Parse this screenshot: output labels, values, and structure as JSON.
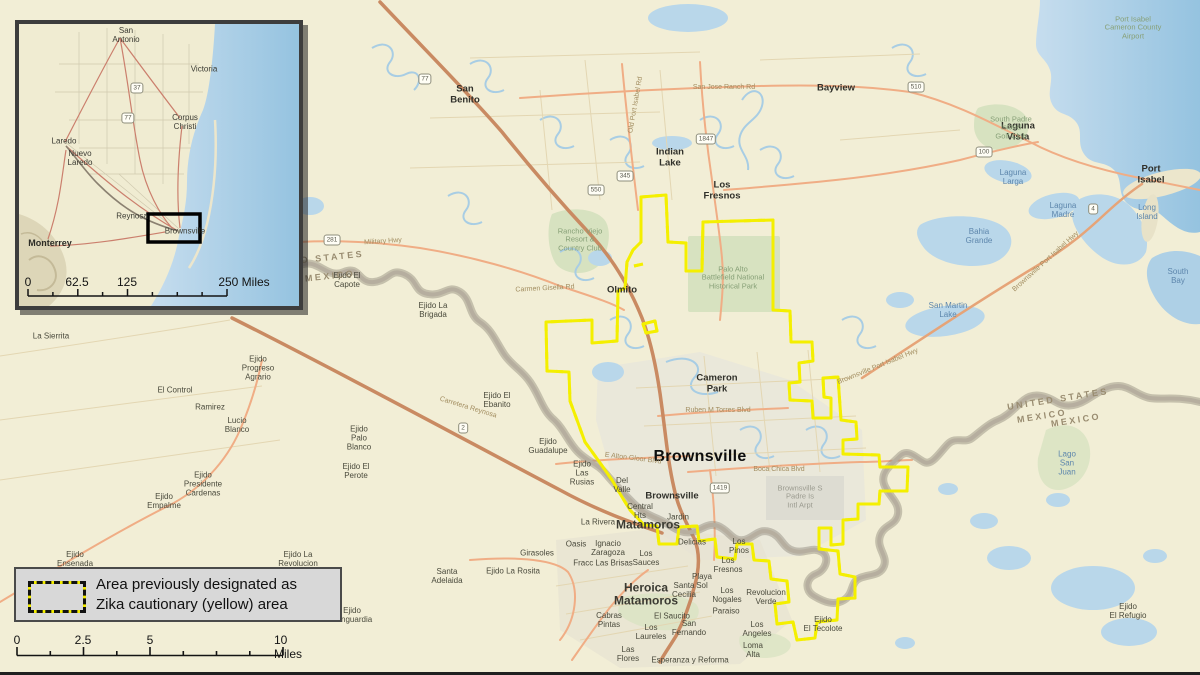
{
  "colors": {
    "land": "#f2eed6",
    "water": "#b9d7ea",
    "water_deep": "#9cc6e0",
    "park": "#d7e2c0",
    "urban": "#e9e6db",
    "airport_gray": "#dddcd2",
    "road_major": "#c98a62",
    "road_secondary": "#f0ad85",
    "river_gray": "#b3ab9c",
    "zika_yellow": "#f4ef00",
    "zika_black": "#141414",
    "legend_bg": "#d8d8d8"
  },
  "legend": {
    "line1": "Area previously designated as",
    "line2": "Zika cautionary (yellow) area"
  },
  "scalebar": {
    "labels": [
      {
        "t": "0",
        "x": 17
      },
      {
        "t": "2.5",
        "x": 83
      },
      {
        "t": "5",
        "x": 150
      },
      {
        "t": "10 Miles",
        "x": 296
      }
    ]
  },
  "inset": {
    "labels": [
      {
        "t": "San\nAntonio",
        "x": 107,
        "y": 12,
        "c": "ins-town"
      },
      {
        "t": "Victoria",
        "x": 185,
        "y": 46,
        "c": "ins-town"
      },
      {
        "t": "Corpus\nChristi",
        "x": 166,
        "y": 99,
        "c": "ins-town"
      },
      {
        "t": "Laredo",
        "x": 45,
        "y": 118,
        "c": "ins-town"
      },
      {
        "t": "Nuevo\nLaredo",
        "x": 61,
        "y": 135,
        "c": "ins-town"
      },
      {
        "t": "Reynosa",
        "x": 113,
        "y": 193,
        "c": "ins-town"
      },
      {
        "t": "Brownsville",
        "x": 166,
        "y": 208,
        "c": "ins-town"
      },
      {
        "t": "Monterrey",
        "x": 31,
        "y": 219,
        "c": "ins-city"
      }
    ],
    "shields": [
      {
        "n": "37",
        "x": 118,
        "y": 64
      },
      {
        "n": "77",
        "x": 109,
        "y": 94
      }
    ],
    "scale_labels": [
      {
        "t": "0",
        "x": 9
      },
      {
        "t": "62.5",
        "x": 58
      },
      {
        "t": "125",
        "x": 108
      },
      {
        "t": "250 Miles",
        "x": 225
      }
    ]
  },
  "map": {
    "labels": [
      {
        "t": "Brownsville",
        "x": 700,
        "y": 457,
        "c": "city"
      },
      {
        "t": "San\nBenito",
        "x": 465,
        "y": 95,
        "c": "town"
      },
      {
        "t": "Bayview",
        "x": 836,
        "y": 89,
        "c": "town"
      },
      {
        "t": "Indian\nLake",
        "x": 670,
        "y": 158,
        "c": "town"
      },
      {
        "t": "Los\nFresnos",
        "x": 722,
        "y": 191,
        "c": "town"
      },
      {
        "t": "Laguna\nVista",
        "x": 1018,
        "y": 132,
        "c": "town"
      },
      {
        "t": "Port\nIsabel",
        "x": 1151,
        "y": 175,
        "c": "town"
      },
      {
        "t": "Olmito",
        "x": 622,
        "y": 291,
        "c": "town"
      },
      {
        "t": "Cameron\nPark",
        "x": 717,
        "y": 384,
        "c": "town"
      },
      {
        "t": "Brownsville",
        "x": 672,
        "y": 497,
        "c": "town"
      },
      {
        "t": "Matamoros",
        "x": 648,
        "y": 525,
        "c": "town2"
      },
      {
        "t": "Heroica\nMatamoros",
        "x": 646,
        "y": 595,
        "c": "town2"
      },
      {
        "t": "Ejido El\nCapote",
        "x": 347,
        "y": 281,
        "c": "place"
      },
      {
        "t": "Ejido La\nBrigada",
        "x": 433,
        "y": 311,
        "c": "place"
      },
      {
        "t": "Ejido El\nEbanito",
        "x": 497,
        "y": 401,
        "c": "place"
      },
      {
        "t": "Ejido\nPalo\nBlanco",
        "x": 359,
        "y": 439,
        "c": "place"
      },
      {
        "t": "Ejido El\nPerote",
        "x": 356,
        "y": 472,
        "c": "place"
      },
      {
        "t": "Ejido\nProgreso\nAgrario",
        "x": 258,
        "y": 369,
        "c": "place"
      },
      {
        "t": "El Control",
        "x": 175,
        "y": 391,
        "c": "place"
      },
      {
        "t": "Ramirez",
        "x": 210,
        "y": 408,
        "c": "place"
      },
      {
        "t": "Lucio\nBlanco",
        "x": 237,
        "y": 426,
        "c": "place"
      },
      {
        "t": "Ejido\nPresidente\nCardenas",
        "x": 203,
        "y": 485,
        "c": "place"
      },
      {
        "t": "Ejido\nEmpalme",
        "x": 164,
        "y": 502,
        "c": "place"
      },
      {
        "t": "La Sierrita",
        "x": 51,
        "y": 337,
        "c": "place"
      },
      {
        "t": "Ejido\nGuadalupe",
        "x": 548,
        "y": 447,
        "c": "place"
      },
      {
        "t": "Ejido\nLas\nRusias",
        "x": 582,
        "y": 474,
        "c": "place"
      },
      {
        "t": "Del\nValle",
        "x": 622,
        "y": 486,
        "c": "place"
      },
      {
        "t": "Central\nHts",
        "x": 640,
        "y": 512,
        "c": "place"
      },
      {
        "t": "Jardin",
        "x": 678,
        "y": 518,
        "c": "place"
      },
      {
        "t": "La Rivera",
        "x": 598,
        "y": 523,
        "c": "place"
      },
      {
        "t": "Ejido\nEnsenada",
        "x": 75,
        "y": 560,
        "c": "place"
      },
      {
        "t": "Ejido La\nRevolucion",
        "x": 298,
        "y": 560,
        "c": "place"
      },
      {
        "t": "Ejido\nVanguardia",
        "x": 352,
        "y": 616,
        "c": "place"
      },
      {
        "t": "Ejido La Rosita",
        "x": 513,
        "y": 572,
        "c": "place"
      },
      {
        "t": "Girasoles",
        "x": 537,
        "y": 554,
        "c": "place"
      },
      {
        "t": "Oasis",
        "x": 576,
        "y": 545,
        "c": "place"
      },
      {
        "t": "Ignacio\nZaragoza",
        "x": 608,
        "y": 549,
        "c": "place"
      },
      {
        "t": "Fracc Las Brisas",
        "x": 603,
        "y": 564,
        "c": "place"
      },
      {
        "t": "Los\nSauces",
        "x": 646,
        "y": 559,
        "c": "place"
      },
      {
        "t": "Delicias",
        "x": 692,
        "y": 543,
        "c": "place"
      },
      {
        "t": "Los\nPinos",
        "x": 739,
        "y": 547,
        "c": "place"
      },
      {
        "t": "Los\nFresnos",
        "x": 728,
        "y": 566,
        "c": "place"
      },
      {
        "t": "Playa\nSol",
        "x": 702,
        "y": 582,
        "c": "place"
      },
      {
        "t": "Santa\nCecilia",
        "x": 684,
        "y": 591,
        "c": "place"
      },
      {
        "t": "Los\nNogales",
        "x": 727,
        "y": 596,
        "c": "place"
      },
      {
        "t": "Paraiso",
        "x": 726,
        "y": 612,
        "c": "place"
      },
      {
        "t": "Revolucion\nVerde",
        "x": 766,
        "y": 598,
        "c": "place"
      },
      {
        "t": "Ejido\nEl Tecolote",
        "x": 823,
        "y": 625,
        "c": "place"
      },
      {
        "t": "Ejido\nEl Refugio",
        "x": 1128,
        "y": 612,
        "c": "place"
      },
      {
        "t": "Cabras\nPintas",
        "x": 609,
        "y": 621,
        "c": "place"
      },
      {
        "t": "El Saucito",
        "x": 672,
        "y": 617,
        "c": "place"
      },
      {
        "t": "San\nFernando",
        "x": 689,
        "y": 629,
        "c": "place"
      },
      {
        "t": "Los\nLaureles",
        "x": 651,
        "y": 633,
        "c": "place"
      },
      {
        "t": "Los\nAngeles",
        "x": 757,
        "y": 630,
        "c": "place"
      },
      {
        "t": "Loma\nAlta",
        "x": 753,
        "y": 651,
        "c": "place"
      },
      {
        "t": "Las\nFlores",
        "x": 628,
        "y": 655,
        "c": "place"
      },
      {
        "t": "Esperanza y Reforma",
        "x": 690,
        "y": 661,
        "c": "place"
      },
      {
        "t": "Santa\nAdelaida",
        "x": 447,
        "y": 577,
        "c": "place"
      },
      {
        "t": "Bahia\nGrande",
        "x": 979,
        "y": 237,
        "c": "water"
      },
      {
        "t": "Laguna\nLarga",
        "x": 1013,
        "y": 178,
        "c": "water"
      },
      {
        "t": "Laguna\nMadre",
        "x": 1063,
        "y": 211,
        "c": "water"
      },
      {
        "t": "Long\nIsland",
        "x": 1147,
        "y": 213,
        "c": "water"
      },
      {
        "t": "South\nBay",
        "x": 1178,
        "y": 277,
        "c": "water"
      },
      {
        "t": "San Martin\nLake",
        "x": 948,
        "y": 311,
        "c": "water"
      },
      {
        "t": "Lago\nSan\nJuan",
        "x": 1067,
        "y": 464,
        "c": "water"
      },
      {
        "t": "Palo Alto\nBattlefield National\nHistorical Park",
        "x": 733,
        "y": 278,
        "c": "park"
      },
      {
        "t": "Rancho Viejo\nResort &\nCountry Club",
        "x": 580,
        "y": 240,
        "c": "park"
      },
      {
        "t": "Port Isabel\nCameron County\nAirport",
        "x": 1133,
        "y": 28,
        "c": "park"
      },
      {
        "t": "South Padre\nIsland\nGolf Club",
        "x": 1011,
        "y": 128,
        "c": "park"
      },
      {
        "t": "Brownsville S\nPadre Is\nIntl Arpt",
        "x": 800,
        "y": 497,
        "c": "airport"
      },
      {
        "t": "Military Hwy",
        "x": 383,
        "y": 242,
        "c": "road",
        "r": -4
      },
      {
        "t": "San Jose Ranch Rd",
        "x": 724,
        "y": 88,
        "c": "road"
      },
      {
        "t": "Carmen Gisella Rd",
        "x": 545,
        "y": 289,
        "c": "road",
        "r": -3
      },
      {
        "t": "Ruben M Torres Blvd",
        "x": 718,
        "y": 411,
        "c": "road"
      },
      {
        "t": "Boca Chica Blvd",
        "x": 779,
        "y": 470,
        "c": "road"
      },
      {
        "t": "E Alton Gloor Blvd",
        "x": 633,
        "y": 459,
        "c": "road",
        "r": 7
      },
      {
        "t": "Brownsville Port Isabel Hwy",
        "x": 878,
        "y": 367,
        "c": "road",
        "r": -22
      },
      {
        "t": "Brownsville Port Isabel Hwy",
        "x": 1046,
        "y": 262,
        "c": "road",
        "r": -42
      },
      {
        "t": "Old Port Isabel Rd",
        "x": 636,
        "y": 105,
        "c": "road",
        "r": -80
      },
      {
        "t": "Carretera Reynosa",
        "x": 468,
        "y": 408,
        "c": "road",
        "r": 17
      },
      {
        "t": "UNITED STATES",
        "x": 1058,
        "y": 399,
        "c": "border",
        "r": -9
      },
      {
        "t": "MEXICO",
        "x": 1042,
        "y": 416,
        "c": "border",
        "r": -9
      },
      {
        "t": "MEXICO",
        "x": 1076,
        "y": 420,
        "c": "border",
        "r": -9
      },
      {
        "t": "UNITED STATES",
        "x": 313,
        "y": 259,
        "c": "border",
        "r": -6
      },
      {
        "t": "MEXICO",
        "x": 330,
        "y": 276,
        "c": "border",
        "r": -6
      }
    ],
    "shields": [
      {
        "n": "77",
        "x": 425,
        "y": 79
      },
      {
        "n": "281",
        "x": 332,
        "y": 240
      },
      {
        "n": "345",
        "x": 625,
        "y": 176
      },
      {
        "n": "1847",
        "x": 706,
        "y": 139
      },
      {
        "n": "510",
        "x": 916,
        "y": 87
      },
      {
        "n": "100",
        "x": 984,
        "y": 152
      },
      {
        "n": "4",
        "x": 1093,
        "y": 209
      },
      {
        "n": "550",
        "x": 596,
        "y": 190
      },
      {
        "n": "2",
        "x": 463,
        "y": 428
      },
      {
        "n": "1419",
        "x": 720,
        "y": 488
      }
    ]
  }
}
